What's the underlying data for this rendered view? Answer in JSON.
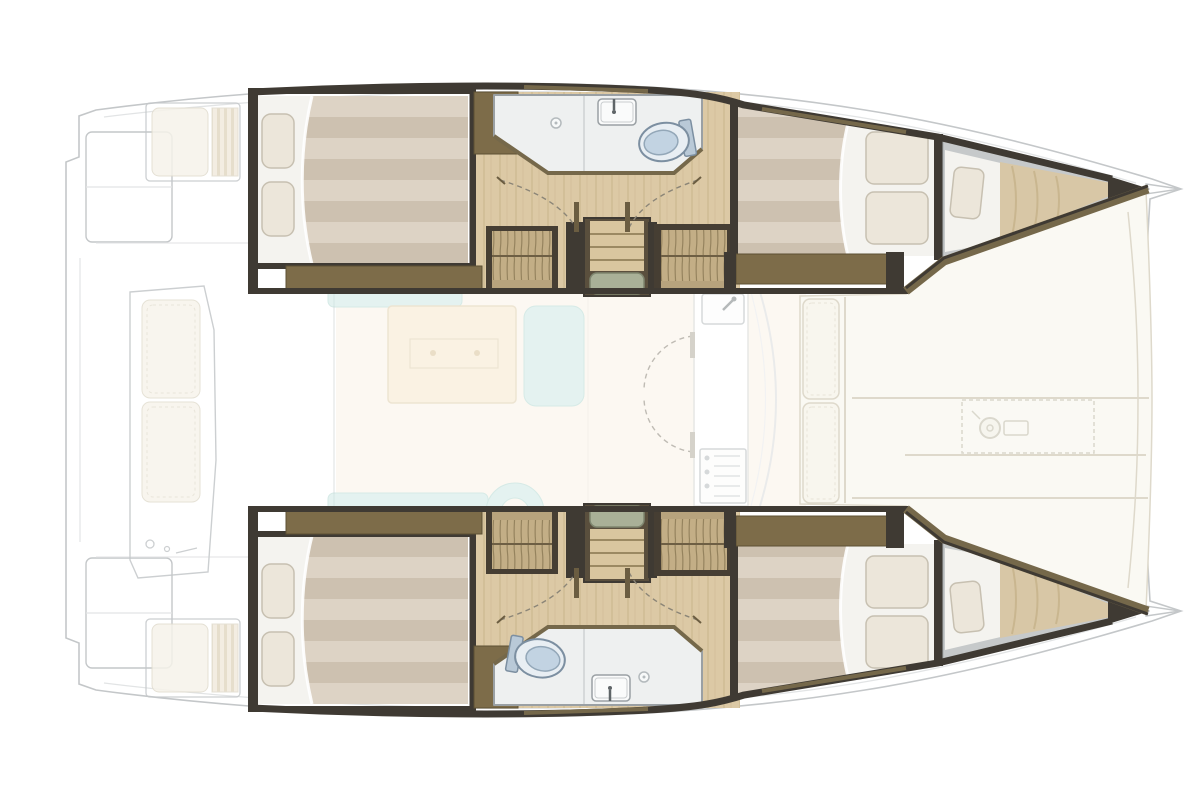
{
  "meta": {
    "type": "floor-plan",
    "subject": "catamaran interior layout",
    "view": "top-down",
    "orientation": "bow-right"
  },
  "palette": {
    "ghost": "#c4c7c9",
    "ghostLight": "#e2e4e5",
    "wallDark": "#3f3a33",
    "wallOlive": "#75684a",
    "stepBrown": "#7d6c49",
    "woodBase": "#dcc9a5",
    "woodLine": "#c0a97f",
    "bedWhite": "#f4f3ef",
    "mattressA": "#ddd3c5",
    "mattressB": "#cdc1b0",
    "pillow": "#ece6da",
    "pillowEdge": "#c7c0b1",
    "bathFloor": "#eef0f0",
    "bathEdge": "#9aa0a4",
    "toiletBowl": "#e8eef3",
    "toiletSeat": "#c2d3e2",
    "toiletEdge": "#7c8fa1",
    "wardrobeTan": "#c3ae86",
    "wardrobeLine": "#8a7854",
    "stairWood": "#d9c69f",
    "stairLine": "#9b8962",
    "stairMat": "#a9b097",
    "stairMatEdge": "#7f866f",
    "sofaAqua": "#cfe9e5",
    "sofaEdge": "#b5d9d3",
    "tableBeige": "#f6e8cd",
    "tableEdge": "#e0cfae",
    "salonFloor": "#f6ecdc",
    "cushion": "#f8f6ee",
    "cushionEdge": "#ded9cb",
    "grayBerth": "#c6c9ca",
    "vMattress": "#d8c7a6",
    "vMattressLine": "#c9b68f",
    "doorDash": "#8b8577"
  },
  "vessel": {
    "hulls": [
      {
        "id": "hull-top",
        "rooms": [
          "aft-cabin-double-berth",
          "head-with-shower-sink-toilet",
          "companionway-stairs",
          "wardrobes",
          "forward-cabin-double-berth",
          "forepeak-berth"
        ]
      },
      {
        "id": "hull-bottom",
        "rooms": [
          "aft-cabin-double-berth",
          "head-with-shower-sink-toilet",
          "companionway-stairs",
          "wardrobes",
          "forward-cabin-double-berth",
          "forepeak-berth"
        ]
      }
    ],
    "bridge_deck": {
      "salon": [
        "u-shaped-settee",
        "dinette-table",
        "galley-sink",
        "galley-stove",
        "forward-door",
        "windshield"
      ],
      "foredeck": [
        "sunpad-cushions",
        "forward-bench-cushions",
        "anchor-windlass-locker"
      ],
      "cockpit": [
        "port-side-bench",
        "starboard-side-bench",
        "aft-transverse-bench",
        "transom-platforms"
      ]
    },
    "icons": [
      "toilet-icon",
      "sink-faucet-icon",
      "shower-drain-icon",
      "stove-burners-icon",
      "windlass-icon",
      "door-swing-icon"
    ]
  }
}
